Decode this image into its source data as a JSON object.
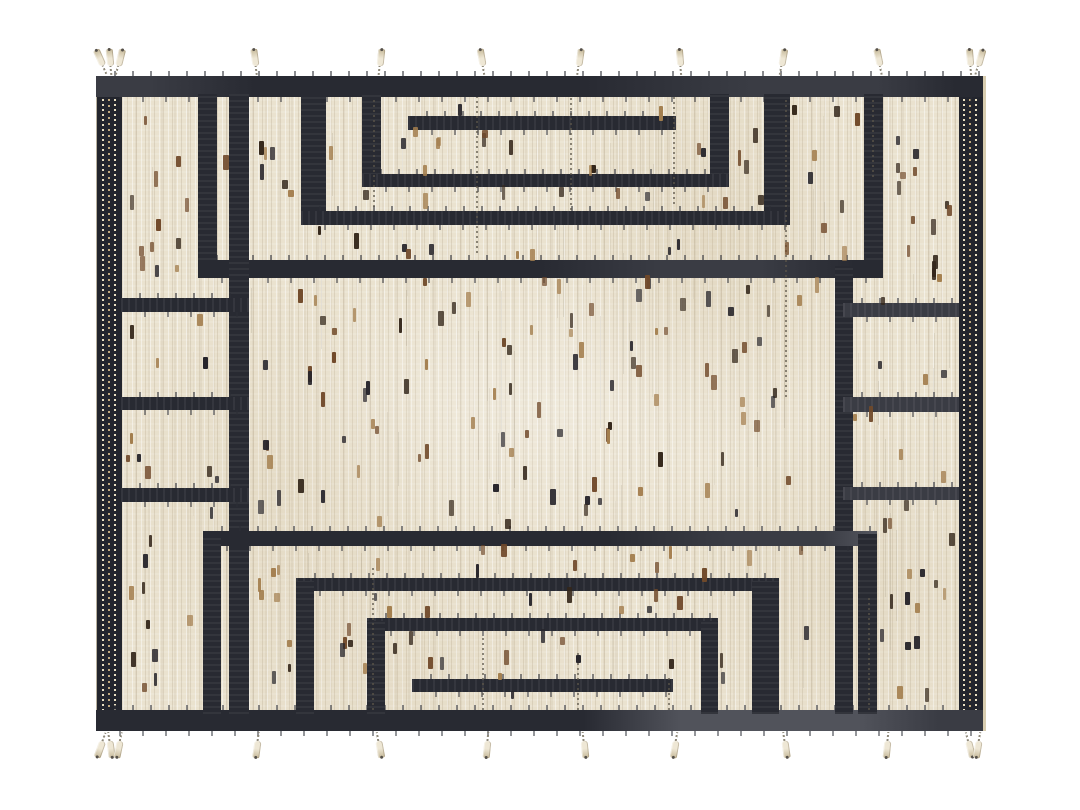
{
  "scene": {
    "description": "Product photograph of a handwoven cream wool rug with dark charcoal geometric meander pattern, dotted selvedge side bands, scattered brown flecks and knotted fringe tassels",
    "page_bg": "#ffffff"
  },
  "rug": {
    "x": 96,
    "y": 76,
    "width": 887,
    "height": 655,
    "palette": {
      "field": "#eae2cf",
      "ink": "#282a32",
      "ink_deep": "#23252d",
      "ink_soft": "#3a3c44",
      "ink_faded": "#51535b",
      "selvedge_dot": "#e9dfc2",
      "selvedge_dot_alt": "#c3ab80",
      "fleck_dark": "#33261a",
      "fleck_brown": "#70492a",
      "fleck_black": "#26242a",
      "fleck_gold": "#a37e4e",
      "tassel": "#eee7d5",
      "tassel_shadow": "#c6b999"
    },
    "selvedges": {
      "left": {
        "x": 0,
        "w": 25
      },
      "right": {
        "x": 863,
        "w": 24
      }
    },
    "bars": [
      {
        "id": "top-band",
        "x": 0,
        "y": 0,
        "w": 887,
        "h": 21,
        "o": "h",
        "tone": "band-top"
      },
      {
        "id": "bottom-band",
        "x": 0,
        "y": 634,
        "w": 887,
        "h": 21,
        "o": "h",
        "tone": "band-bottom"
      },
      {
        "id": "u1-left-leg",
        "x": 102,
        "y": 18,
        "w": 19,
        "h": 184,
        "o": "v"
      },
      {
        "id": "u1-right-leg",
        "x": 768,
        "y": 18,
        "w": 19,
        "h": 184,
        "o": "v"
      },
      {
        "id": "u1-bottom-bar",
        "x": 102,
        "y": 184,
        "w": 685,
        "h": 18,
        "o": "h",
        "tone": "h1tone"
      },
      {
        "id": "u15-left-leg",
        "x": 205,
        "y": 18,
        "w": 25,
        "h": 131,
        "o": "v"
      },
      {
        "id": "u15-right-leg",
        "x": 668,
        "y": 18,
        "w": 26,
        "h": 131,
        "o": "v"
      },
      {
        "id": "u15-bottom-bar",
        "x": 205,
        "y": 135,
        "w": 489,
        "h": 14,
        "o": "h"
      },
      {
        "id": "u2-left-leg",
        "x": 266,
        "y": 18,
        "w": 19,
        "h": 93,
        "o": "v"
      },
      {
        "id": "u2-right-leg",
        "x": 614,
        "y": 18,
        "w": 19,
        "h": 93,
        "o": "v"
      },
      {
        "id": "u2-bottom-bar",
        "x": 266,
        "y": 98,
        "w": 367,
        "h": 13,
        "o": "h"
      },
      {
        "id": "inner-bar-top",
        "x": 312,
        "y": 40,
        "w": 268,
        "h": 14,
        "o": "h"
      },
      {
        "id": "left-divider",
        "x": 133,
        "y": 18,
        "w": 20,
        "h": 620,
        "o": "v"
      },
      {
        "id": "right-divider",
        "x": 739,
        "y": 190,
        "w": 18,
        "h": 448,
        "o": "v"
      },
      {
        "id": "left-box-line-1",
        "x": 25,
        "y": 222,
        "w": 128,
        "h": 14,
        "o": "h"
      },
      {
        "id": "left-box-line-2",
        "x": 25,
        "y": 321,
        "w": 128,
        "h": 13,
        "o": "h"
      },
      {
        "id": "left-box-line-3",
        "x": 25,
        "y": 412,
        "w": 128,
        "h": 14,
        "o": "h"
      },
      {
        "id": "right-box-line-1",
        "x": 747,
        "y": 227,
        "w": 116,
        "h": 14,
        "o": "h",
        "tone": "soft"
      },
      {
        "id": "right-box-line-2",
        "x": 747,
        "y": 321,
        "w": 116,
        "h": 15,
        "o": "h",
        "tone": "soft"
      },
      {
        "id": "right-box-line-3",
        "x": 747,
        "y": 411,
        "w": 116,
        "h": 13,
        "o": "h",
        "tone": "soft"
      },
      {
        "id": "u1b-top-bar",
        "x": 107,
        "y": 455,
        "w": 674,
        "h": 15,
        "o": "h",
        "tone": "u1ptone"
      },
      {
        "id": "u1b-left-leg",
        "x": 107,
        "y": 458,
        "w": 18,
        "h": 180,
        "o": "v"
      },
      {
        "id": "u1b-right-leg",
        "x": 762,
        "y": 458,
        "w": 19,
        "h": 180,
        "o": "v"
      },
      {
        "id": "u15b-top-bar",
        "x": 200,
        "y": 502,
        "w": 483,
        "h": 13,
        "o": "h"
      },
      {
        "id": "u15b-left-leg",
        "x": 200,
        "y": 505,
        "w": 18,
        "h": 133,
        "o": "v"
      },
      {
        "id": "u15b-right-leg",
        "x": 656,
        "y": 505,
        "w": 27,
        "h": 133,
        "o": "v"
      },
      {
        "id": "u2b-top-bar",
        "x": 271,
        "y": 542,
        "w": 351,
        "h": 13,
        "o": "h"
      },
      {
        "id": "u2b-left-leg",
        "x": 271,
        "y": 545,
        "w": 18,
        "h": 93,
        "o": "v"
      },
      {
        "id": "u2b-right-leg",
        "x": 605,
        "y": 545,
        "w": 17,
        "h": 93,
        "o": "v"
      },
      {
        "id": "inner-bar-bottom",
        "x": 316,
        "y": 603,
        "w": 261,
        "h": 13,
        "o": "h"
      }
    ],
    "warp_strings": {
      "top": [
        {
          "x": 277,
          "y": 21,
          "len": 110
        },
        {
          "x": 380,
          "y": 21,
          "len": 156
        },
        {
          "x": 474,
          "y": 21,
          "len": 113
        },
        {
          "x": 577,
          "y": 21,
          "len": 107
        },
        {
          "x": 689,
          "y": 21,
          "len": 300
        },
        {
          "x": 776,
          "y": 21,
          "len": 80
        }
      ],
      "bottom": [
        {
          "x": 276,
          "y": 490,
          "len": 144
        },
        {
          "x": 386,
          "y": 560,
          "len": 74
        },
        {
          "x": 481,
          "y": 575,
          "len": 59
        },
        {
          "x": 572,
          "y": 600,
          "len": 34
        },
        {
          "x": 772,
          "y": 520,
          "len": 114
        }
      ]
    },
    "fringe": {
      "top": [
        {
          "x": -2,
          "angle": -24
        },
        {
          "x": 7,
          "angle": -6
        },
        {
          "x": 16,
          "angle": 14
        },
        {
          "x": 152,
          "angle": -8
        },
        {
          "x": 277,
          "angle": 6
        },
        {
          "x": 379,
          "angle": -10
        },
        {
          "x": 476,
          "angle": 8
        },
        {
          "x": 577,
          "angle": -5
        },
        {
          "x": 679,
          "angle": 10
        },
        {
          "x": 776,
          "angle": -12
        },
        {
          "x": 867,
          "angle": -5
        },
        {
          "x": 876,
          "angle": 16
        }
      ],
      "bottom": [
        {
          "x": -2,
          "angle": 20
        },
        {
          "x": 7,
          "angle": -8
        },
        {
          "x": 16,
          "angle": 12
        },
        {
          "x": 154,
          "angle": 8
        },
        {
          "x": 276,
          "angle": -10
        },
        {
          "x": 384,
          "angle": 6
        },
        {
          "x": 481,
          "angle": -6
        },
        {
          "x": 572,
          "angle": 10
        },
        {
          "x": 682,
          "angle": -8
        },
        {
          "x": 784,
          "angle": 6
        },
        {
          "x": 866,
          "angle": -14
        },
        {
          "x": 875,
          "angle": 10
        }
      ]
    },
    "texture": {
      "fleck_seed": 97,
      "fleck_count": 360,
      "fleck_area": {
        "x1": 30,
        "y1": 26,
        "x2": 855,
        "y2": 628
      },
      "fleck_colors": [
        "fleck_dark",
        "fleck_brown",
        "fleck_black",
        "fleck_gold"
      ],
      "streak_count": 80
    }
  }
}
